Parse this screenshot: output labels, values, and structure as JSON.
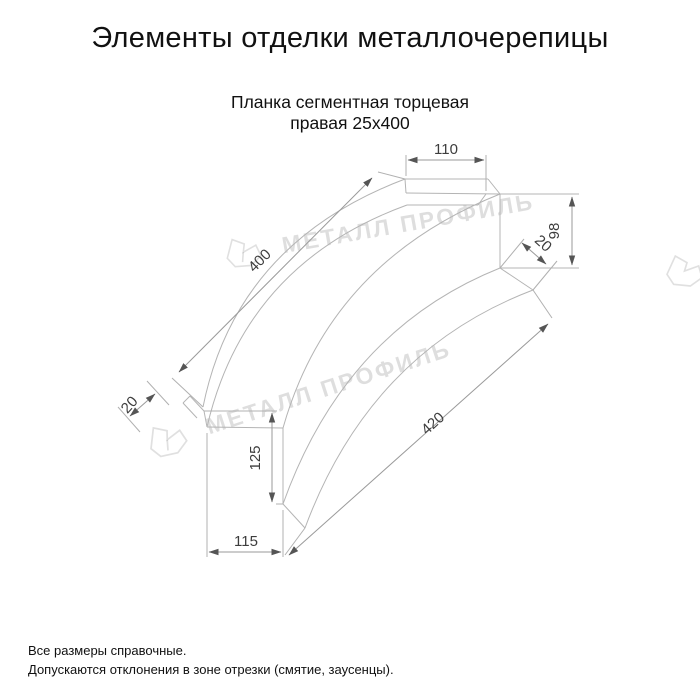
{
  "title": "Элементы отделки металлочерепицы",
  "subtitle": {
    "line1": "Планка сегментная торцевая",
    "line2": "правая 25x400"
  },
  "watermark": {
    "text": "МЕТАЛЛ ПРОФИЛЬ"
  },
  "dimensions": {
    "top_flange_width": "110",
    "right_end_height": "98",
    "right_kick": "20",
    "top_edge_length": "400",
    "bottom_edge_length": "420",
    "left_hem": "20",
    "left_end_height": "125",
    "left_flange_width": "115"
  },
  "footer": {
    "line1": "Все размеры справочные.",
    "line2": "Допускаются отклонения в зоне отрезки (смятие, заусенцы)."
  },
  "colors": {
    "drawing_line": "#b4b4b4",
    "dimension_text": "#3d3d3d",
    "body_text": "#111111",
    "watermark": "rgba(0,0,0,0.13)",
    "arrow": "#555555"
  }
}
